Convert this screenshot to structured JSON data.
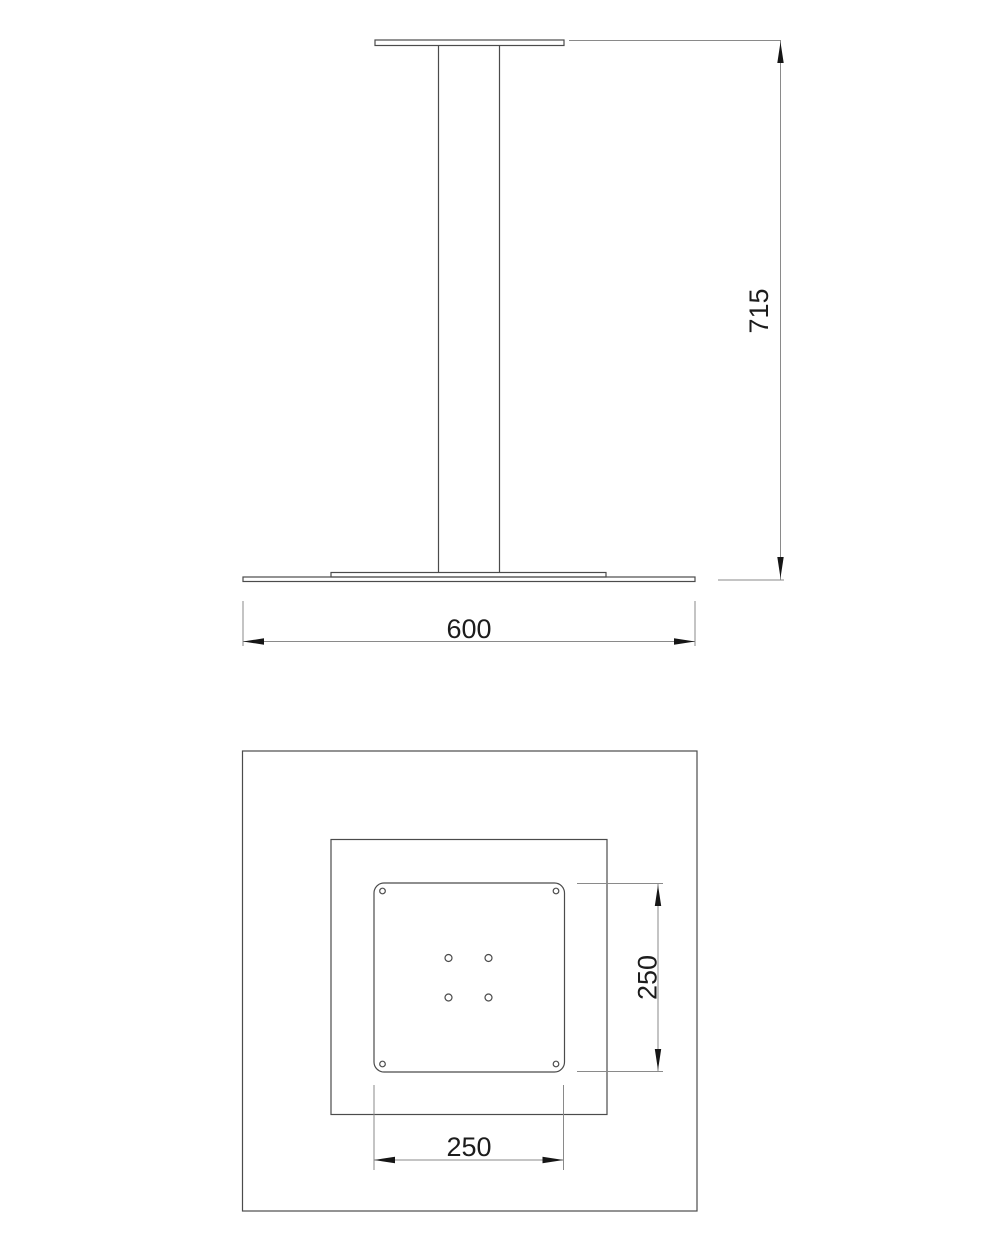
{
  "colors": {
    "background": "#ffffff",
    "object_line": "#4b4b4b",
    "plate_line": "#7d7d7d",
    "dimension_line": "#8a8a8a",
    "arrow": "#161616",
    "text": "#1c1c1c"
  },
  "front_view": {
    "height_dim": "715",
    "width_dim": "600"
  },
  "plan_view": {
    "plate_height_dim": "250",
    "plate_width_dim": "250"
  }
}
